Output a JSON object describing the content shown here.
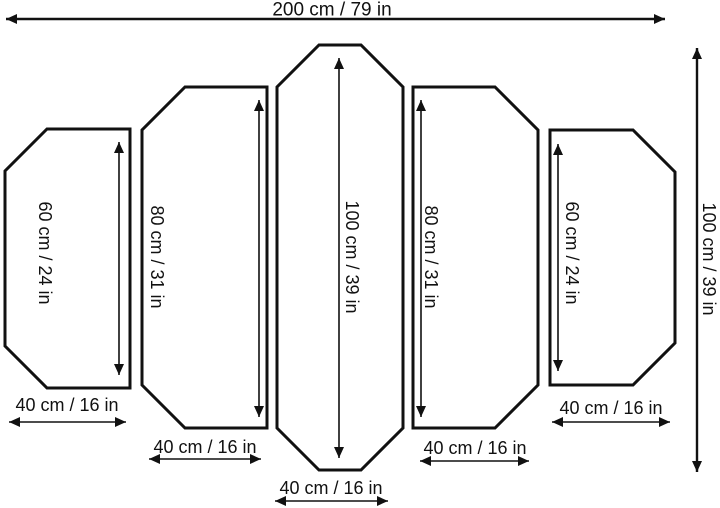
{
  "colors": {
    "line": "#111111",
    "background": "#ffffff",
    "text": "#111111"
  },
  "overall": {
    "width_label": "200 cm / 79 in",
    "height_label": "100 cm / 39 in"
  },
  "panels": [
    {
      "position": "far-left",
      "height_label": "60 cm / 24 in",
      "width_label": "40 cm / 16 in"
    },
    {
      "position": "left",
      "height_label": "80 cm / 31 in",
      "width_label": "40 cm / 16 in"
    },
    {
      "position": "center",
      "height_label": "100 cm / 39 in",
      "width_label": "40 cm / 16 in"
    },
    {
      "position": "right",
      "height_label": "80 cm / 31 in",
      "width_label": "40 cm / 16 in"
    },
    {
      "position": "far-right",
      "height_label": "60 cm / 24 in",
      "width_label": "40 cm / 16 in"
    }
  ]
}
